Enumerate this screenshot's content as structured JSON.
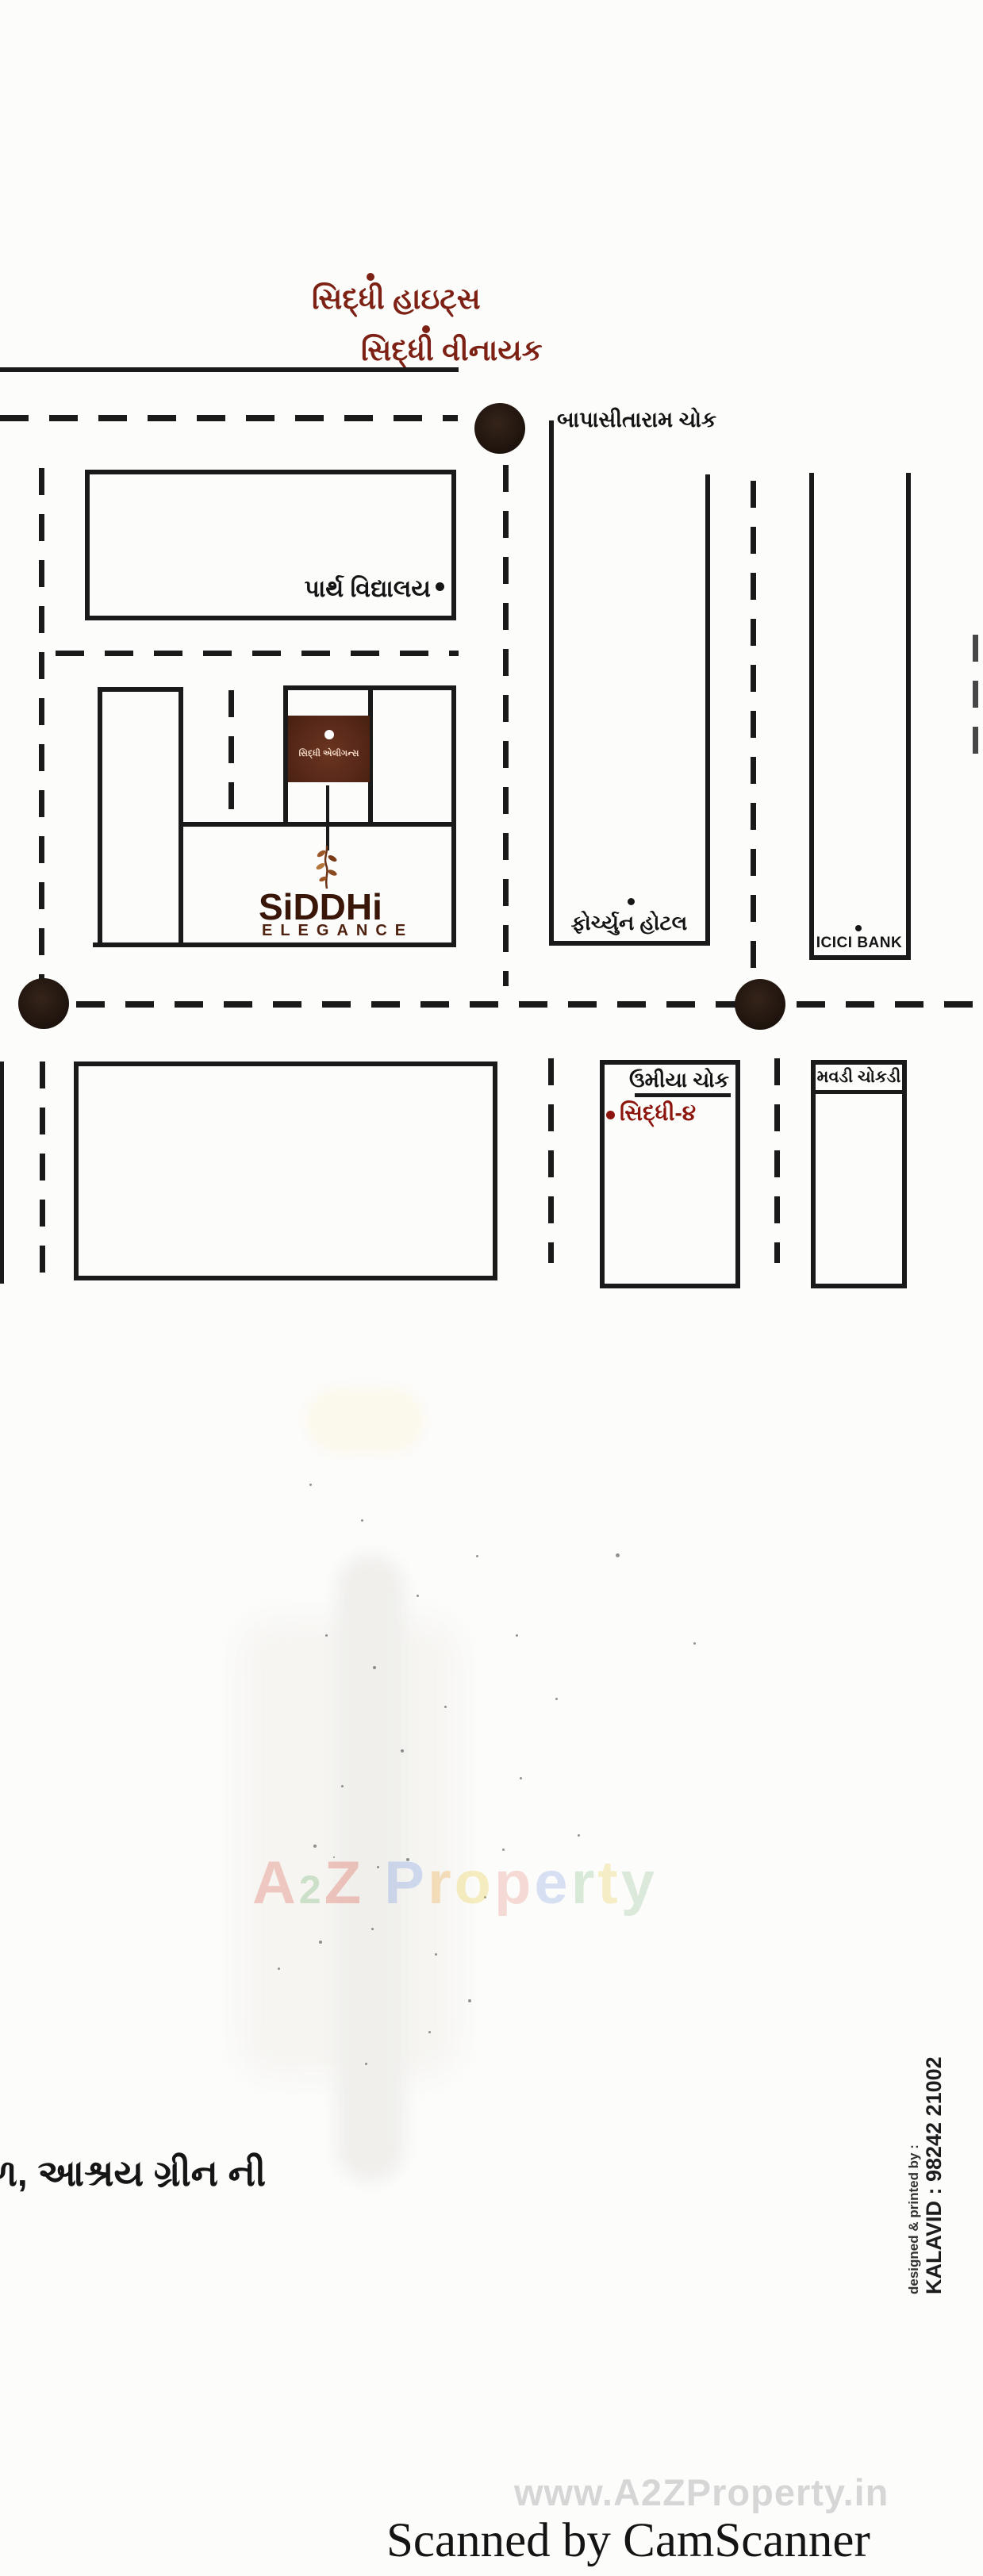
{
  "header": {
    "title_line1": "સિદ્ધી હાઇટ્સ",
    "title_line2": "સિદ્ધી વીનાયક"
  },
  "map": {
    "landmarks": {
      "bapasitaram_chowk": "બાપાસીતારામ ચોક",
      "parth_vidyalay": "પાર્થ વિદ્યાલય",
      "fortune_hotel": "ફોર્ચ્યુન હોટલ",
      "icici_bank": "ICICI BANK",
      "umiya_chowk": "ઉમીયા ચોક",
      "siddhi_4": "સિદ્ધી-૪",
      "mavdi_chokdi": "મવડી ચોકડી"
    },
    "site": {
      "plot_label": "સિદ્ધી એલીગન્સ",
      "logo_name": "SiDDHi",
      "logo_sub": "ELEGANCE"
    },
    "colors": {
      "ink": "#1a1a1a",
      "brand_maroon": "#7c2114",
      "logo_brown": "#391608",
      "site_box_brown": "#59291a",
      "accent_red": "#8c150e",
      "watermark_gray": "#d6d6d6"
    }
  },
  "watermark_center": {
    "text": "A2Z Property",
    "letters": [
      {
        "ch": "A",
        "color": "#e0685c"
      },
      {
        "ch": "2",
        "color": "#74b274",
        "small": true
      },
      {
        "ch": "Z",
        "color": "#dd5f4e"
      },
      {
        "ch": " ",
        "color": "#ffffff"
      },
      {
        "ch": "P",
        "color": "#7d9ce2"
      },
      {
        "ch": "r",
        "color": "#eca53f"
      },
      {
        "ch": "o",
        "color": "#e9cd4a"
      },
      {
        "ch": "p",
        "color": "#e59184"
      },
      {
        "ch": "e",
        "color": "#8ba8e4"
      },
      {
        "ch": "r",
        "color": "#92c492"
      },
      {
        "ch": "t",
        "color": "#e5cf58"
      },
      {
        "ch": "y",
        "color": "#97c497"
      }
    ]
  },
  "footer_note": "ળ, આશ્રય ગ્રીન ની",
  "credits": {
    "line1": "designed & printed by :",
    "line2": "KALAVID : 98242 21002"
  },
  "watermark_bottom": "www.A2ZProperty.in",
  "scanner_caption": "Scanned by CamScanner"
}
